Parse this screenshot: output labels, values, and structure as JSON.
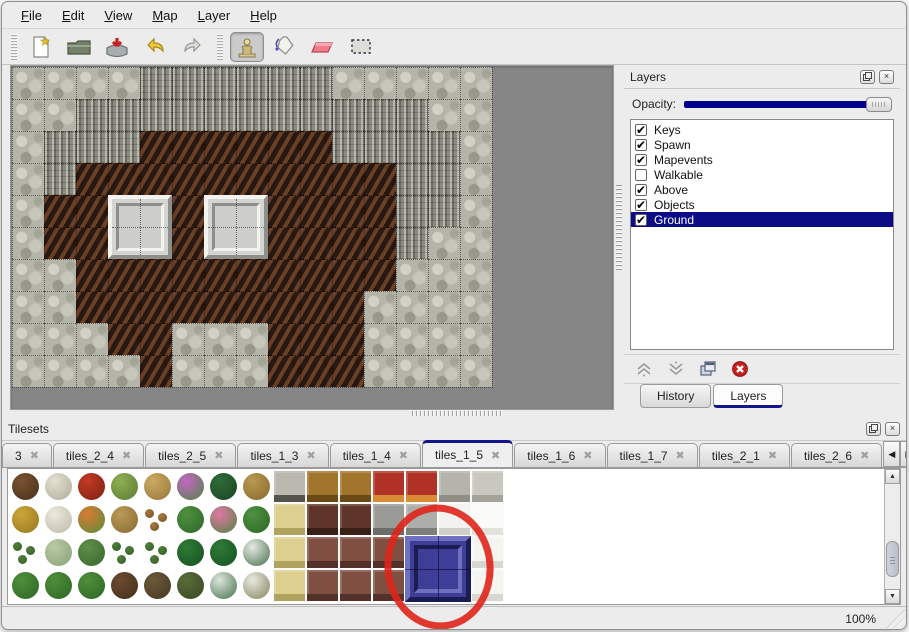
{
  "menu": {
    "items": [
      "File",
      "Edit",
      "View",
      "Map",
      "Layer",
      "Help"
    ]
  },
  "toolbar": {
    "active_tool": "stamp",
    "buttons": [
      "new",
      "open",
      "save",
      "undo",
      "redo",
      "stamp",
      "fill",
      "eraser",
      "select"
    ]
  },
  "icons": {
    "check": "✔",
    "panel_close": "×",
    "tab_close": "✖",
    "scroll_up": "▲",
    "scroll_down": "▼",
    "tab_left": "◀",
    "tab_right": "▶",
    "star": "★"
  },
  "layers_panel": {
    "title": "Layers",
    "opacity_label": "Opacity:",
    "opacity_value": 100,
    "layers": [
      {
        "name": "Keys",
        "checked": true,
        "selected": false
      },
      {
        "name": "Spawn",
        "checked": true,
        "selected": false
      },
      {
        "name": "Mapevents",
        "checked": true,
        "selected": false
      },
      {
        "name": "Walkable",
        "checked": false,
        "selected": false
      },
      {
        "name": "Above",
        "checked": true,
        "selected": false
      },
      {
        "name": "Objects",
        "checked": true,
        "selected": false
      },
      {
        "name": "Ground",
        "checked": true,
        "selected": true
      }
    ],
    "tabs": [
      {
        "label": "History",
        "active": false
      },
      {
        "label": "Layers",
        "active": true
      }
    ]
  },
  "tilesets_panel": {
    "title": "Tilesets",
    "tabs": [
      {
        "label": "3",
        "active": false
      },
      {
        "label": "tiles_2_4",
        "active": false
      },
      {
        "label": "tiles_2_5",
        "active": false
      },
      {
        "label": "tiles_1_3",
        "active": false
      },
      {
        "label": "tiles_1_4",
        "active": false
      },
      {
        "label": "tiles_1_5",
        "active": true
      },
      {
        "label": "tiles_1_6",
        "active": false
      },
      {
        "label": "tiles_1_7",
        "active": false
      },
      {
        "label": "tiles_2_1",
        "active": false
      },
      {
        "label": "tiles_2_6",
        "active": false
      }
    ]
  },
  "statusbar": {
    "zoom": "100%"
  },
  "map": {
    "tile_size": 32,
    "tile_legend": {
      "P": "pebble-rock",
      "C": "cliff-rock",
      "F": "cave-floor",
      "S": "platform-base"
    },
    "grid": [
      "PPPPCCCCCCPPPPP",
      "PPCCCCCCCCCCCPP",
      "PCCCFFFFFFCCCCP",
      "PCFFFFFFFFFFCCP",
      "PFFSSFSSFFFFCCP",
      "PFFSSFSSFFFFCPP",
      "PPFFFFFFFFFFPPP",
      "PPFFFFFFFFFPPPP",
      "PPPFFPPPFFFPPPP",
      "PPPPFPPPFFFPPPP"
    ],
    "platforms": [
      {
        "col": 3,
        "row": 4
      },
      {
        "col": 6,
        "row": 4
      }
    ]
  },
  "tileset_grid": {
    "cell_size": 33,
    "cells": [
      [
        0,
        0,
        "blob",
        "#7a5230",
        "#46301c"
      ],
      [
        1,
        0,
        "blob",
        "#e4e0d2",
        "#b0ac98"
      ],
      [
        2,
        0,
        "blob",
        "#c23a24",
        "#7e2012"
      ],
      [
        3,
        0,
        "blob",
        "#8fae52",
        "#5c7c34"
      ],
      [
        4,
        0,
        "blob",
        "#cbaa62",
        "#96763a"
      ],
      [
        5,
        0,
        "blob",
        "#c467c4",
        "#4f8444"
      ],
      [
        6,
        0,
        "blob",
        "#2f6b3a",
        "#1a4522"
      ],
      [
        7,
        0,
        "blob",
        "#b99a50",
        "#85672c"
      ],
      [
        8,
        0,
        "block",
        "#b9b9af",
        "#55554d"
      ],
      [
        9,
        0,
        "block",
        "#a1762c",
        "#6b4a16"
      ],
      [
        10,
        0,
        "block",
        "#a1762c",
        "#6b4a16"
      ],
      [
        11,
        0,
        "block",
        "#b03226",
        "#d98a34"
      ],
      [
        12,
        0,
        "block",
        "#b03226",
        "#d98a34"
      ],
      [
        13,
        0,
        "block",
        "#b4b4aa",
        "#8f8f85"
      ],
      [
        14,
        0,
        "block",
        "#c8c8be",
        "#a3a399"
      ],
      [
        0,
        1,
        "blob",
        "#cda43a",
        "#96781e"
      ],
      [
        1,
        1,
        "blob",
        "#eceade",
        "#bcb8a8"
      ],
      [
        2,
        1,
        "blob",
        "#d97a33",
        "#5c8c38"
      ],
      [
        3,
        1,
        "blob",
        "#bb9b58",
        "#876932"
      ],
      [
        4,
        1,
        "dots",
        "#a87a40",
        "#744f22"
      ],
      [
        5,
        1,
        "blob",
        "#4f9140",
        "#2c6626"
      ],
      [
        6,
        1,
        "blob",
        "#e277a3",
        "#4f8444"
      ],
      [
        7,
        1,
        "blob",
        "#4f9140",
        "#2c6626"
      ],
      [
        8,
        1,
        "block",
        "#ddd08e",
        "#b0a35f"
      ],
      [
        9,
        1,
        "block",
        "#5f352b",
        "#3a1f16"
      ],
      [
        10,
        1,
        "block",
        "#5f352b",
        "#3a1f16"
      ],
      [
        11,
        1,
        "block",
        "#9a9a96",
        "#6c6c68"
      ],
      [
        12,
        1,
        "block",
        "#adada9",
        "#7e7e7a"
      ],
      [
        13,
        1,
        "block",
        "#f2f2ee",
        "#cfcfc7"
      ],
      [
        14,
        1,
        "block",
        "#fafaf8",
        "#e2e2da"
      ],
      [
        0,
        2,
        "dots",
        "#4f7f38",
        "#315e26"
      ],
      [
        1,
        2,
        "blob",
        "#b9c9a4",
        "#8aa175"
      ],
      [
        2,
        2,
        "blob",
        "#5f8f4a",
        "#3a662c"
      ],
      [
        3,
        2,
        "dots",
        "#4f7f38",
        "#315e26"
      ],
      [
        4,
        2,
        "dots",
        "#4f7f38",
        "#315e26"
      ],
      [
        5,
        2,
        "blob",
        "#2f7b36",
        "#155020"
      ],
      [
        6,
        2,
        "blob",
        "#2f7b36",
        "#155020"
      ],
      [
        7,
        2,
        "blob",
        "#e6eae6",
        "#47704a"
      ],
      [
        8,
        2,
        "block",
        "#ddd08e",
        "#b0a35f"
      ],
      [
        9,
        2,
        "block",
        "#7f4f42",
        "#54302a"
      ],
      [
        10,
        2,
        "block",
        "#7f4f42",
        "#54302a"
      ],
      [
        11,
        2,
        "block",
        "#7f4f42",
        "#54302a"
      ],
      [
        14,
        2,
        "block",
        "#f4f4f0",
        "#d8d8d0"
      ],
      [
        0,
        3,
        "blob",
        "#4f8f3a",
        "#2c6626"
      ],
      [
        1,
        3,
        "blob",
        "#4f8f3a",
        "#2c6626"
      ],
      [
        2,
        3,
        "blob",
        "#4f8f3a",
        "#2c6626"
      ],
      [
        3,
        3,
        "blob",
        "#6b4a2f",
        "#45301c"
      ],
      [
        4,
        3,
        "blob",
        "#6b5a3a",
        "#443622"
      ],
      [
        5,
        3,
        "blob",
        "#5a6b3a",
        "#384722"
      ],
      [
        6,
        3,
        "blob",
        "#dde6dd",
        "#46704a"
      ],
      [
        7,
        3,
        "blob",
        "#e8e8e0",
        "#84845e"
      ],
      [
        8,
        3,
        "block",
        "#ddd08e",
        "#b0a35f"
      ],
      [
        9,
        3,
        "block",
        "#7f4f42",
        "#54302a"
      ],
      [
        10,
        3,
        "block",
        "#7f4f42",
        "#54302a"
      ],
      [
        11,
        3,
        "block",
        "#7f4f42",
        "#54302a"
      ],
      [
        14,
        3,
        "block",
        "#f4f4f0",
        "#d8d8d0"
      ]
    ],
    "selected_blue_tile": {
      "col": 12,
      "row": 2,
      "span": 2,
      "color": "#3e3e96"
    },
    "annotation": {
      "shape": "ellipse",
      "color": "#df231b"
    }
  },
  "colors": {
    "accent_navy": "#00008c",
    "selection_bg": "#0c0c85",
    "canvas_gray": "#868686",
    "chrome_bg": "#ececec"
  }
}
